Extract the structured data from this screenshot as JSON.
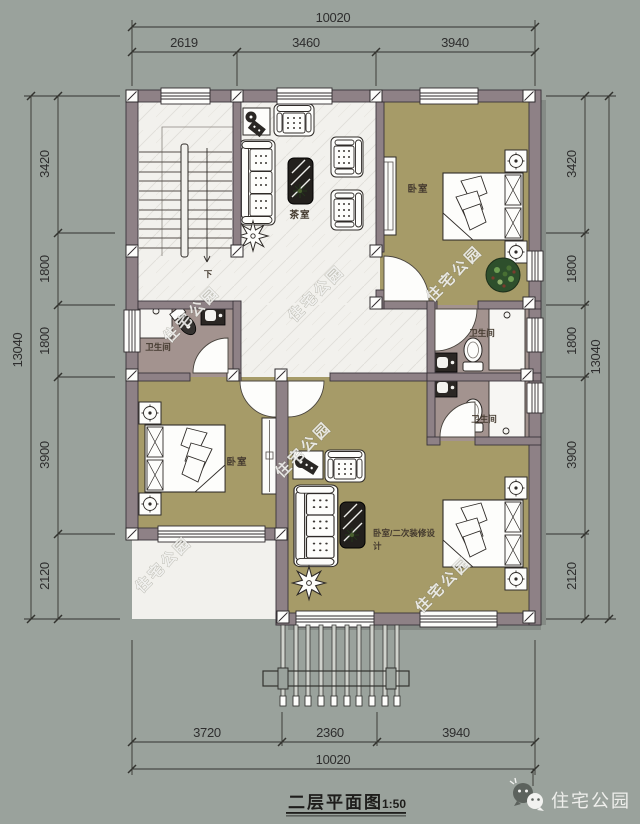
{
  "meta": {
    "caption": "二层平面图",
    "scale": "1:50",
    "brand": "住宅公园",
    "watermark": "住宅公园"
  },
  "labels": {
    "tea_room": "茶室",
    "bedroom": "卧室",
    "bathroom": "卫生间",
    "bedroom_secondary_line1": "卧室/二次装修设",
    "bedroom_secondary_line2": "计",
    "stair_down": "下"
  },
  "dimensions": {
    "top": {
      "total": "10020",
      "segments": [
        "2619",
        "3460",
        "3940"
      ]
    },
    "bottom": {
      "total": "10020",
      "segments": [
        "3720",
        "2360",
        "3940"
      ]
    },
    "left": {
      "total": "13040",
      "segments": [
        "3420",
        "1800",
        "1800",
        "3900",
        "2120"
      ]
    },
    "right": {
      "total": "13040",
      "segments": [
        "3420",
        "1800",
        "1800",
        "3900",
        "2120"
      ]
    }
  },
  "colors": {
    "background": "#9aa29c",
    "wall": "#8e8186",
    "floor_white": "#f2f1ed",
    "floor_bedroom": "#a69b68",
    "floor_bathroom": "#a3938f",
    "dimension_text": "#2e2e2e",
    "furniture_dark": "#2a2724",
    "plant_green": "#2e4f2c"
  }
}
